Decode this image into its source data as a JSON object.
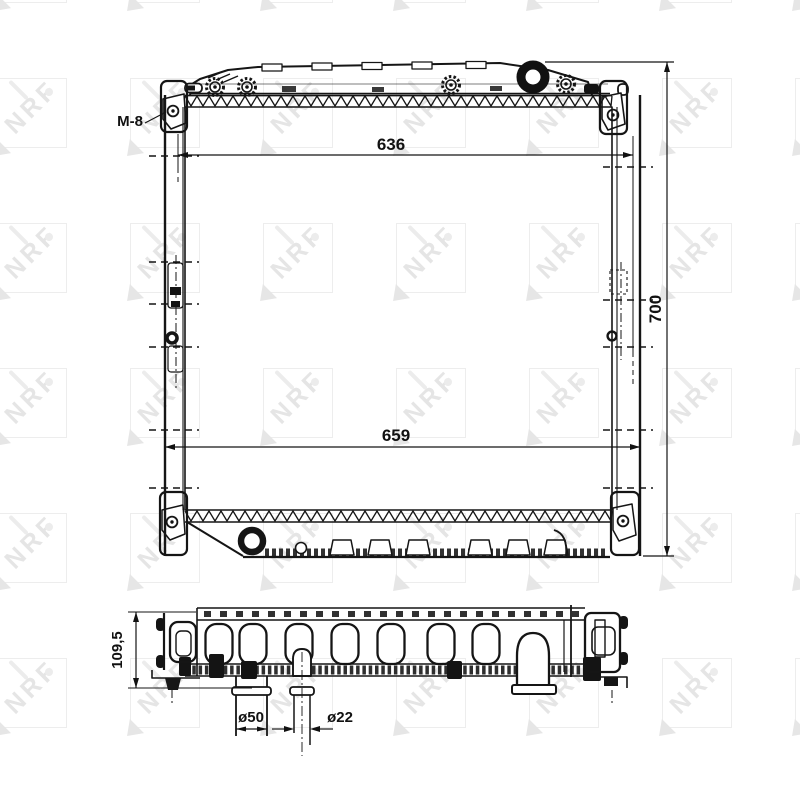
{
  "colors": {
    "line": "#151515",
    "watermark": "#e6e6e6",
    "background": "#ffffff"
  },
  "watermark": {
    "text": "NRF"
  },
  "front_view": {
    "thread_label": "M-8",
    "core_width": "636",
    "overall_width": "659",
    "overall_height": "700"
  },
  "bottom_view": {
    "depth": "109,5",
    "inlet_pipe_diameter": "ø50",
    "filler_pipe_diameter": "ø22"
  }
}
